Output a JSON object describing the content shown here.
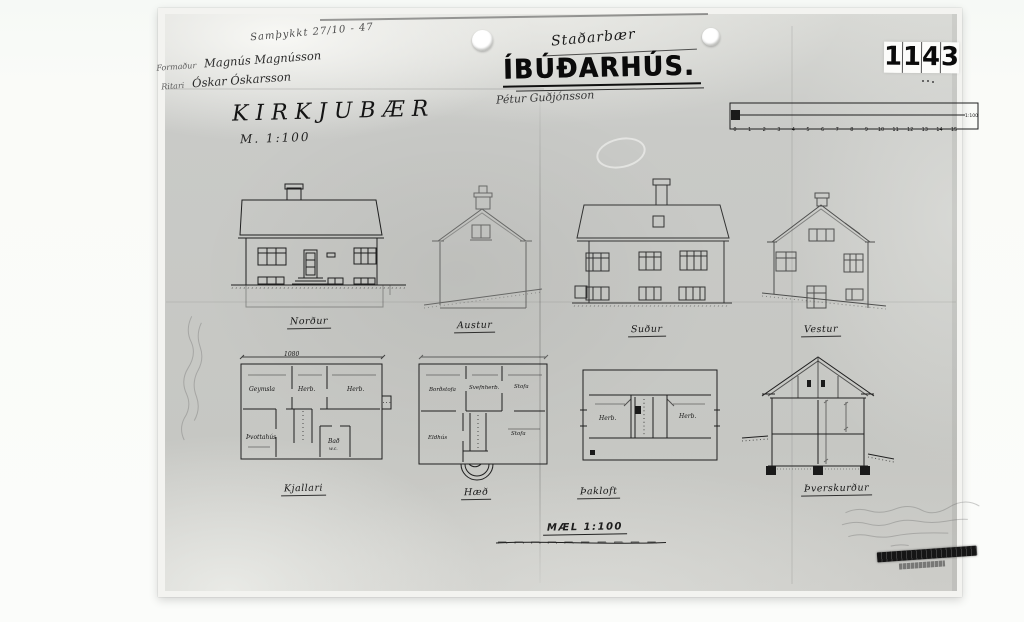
{
  "doc": {
    "approval_note": "Samþykkt 27/10 - 47",
    "officials": [
      {
        "role": "Formaður",
        "name": "Magnús Magnússon"
      },
      {
        "role": "Ritari",
        "name": "Óskar Óskarsson"
      }
    ],
    "site_name": "KIRKJUBÆR",
    "site_scale_note": "M. 1:100",
    "farm_name": "Staðarbær",
    "title": "ÍBÚÐARHÚS.",
    "signature": "Pétur Guðjónsson",
    "sheet_number": {
      "digits": [
        "1",
        "1",
        "4",
        "3"
      ]
    },
    "ruler": {
      "ticks": [
        "0",
        "1",
        "2",
        "3",
        "4",
        "5",
        "6",
        "7",
        "8",
        "9",
        "10",
        "11",
        "12",
        "13",
        "14",
        "15"
      ],
      "scale_label": "1:100"
    },
    "elevations": [
      {
        "label": "Norður"
      },
      {
        "label": "Austur"
      },
      {
        "label": "Suður"
      },
      {
        "label": "Vestur"
      }
    ],
    "plans": {
      "kjallari": {
        "label": "Kjallari",
        "top_dimension": "1080",
        "rooms": [
          "Geymsla",
          "Herb.",
          "Herb.",
          "Þvottahús",
          "Bað"
        ],
        "wc_note": "w.c."
      },
      "haed": {
        "label": "Hæð",
        "rooms": [
          "Borðstofa",
          "Svefnherb.",
          "Stofa",
          "Eldhús",
          "Stofa"
        ]
      },
      "thakloft": {
        "label": "Þakloft",
        "rooms": [
          "Herb.",
          "Herb."
        ]
      },
      "section": {
        "label": "Þverskurður"
      }
    },
    "scale_bar_label": "MÆL 1:100"
  }
}
